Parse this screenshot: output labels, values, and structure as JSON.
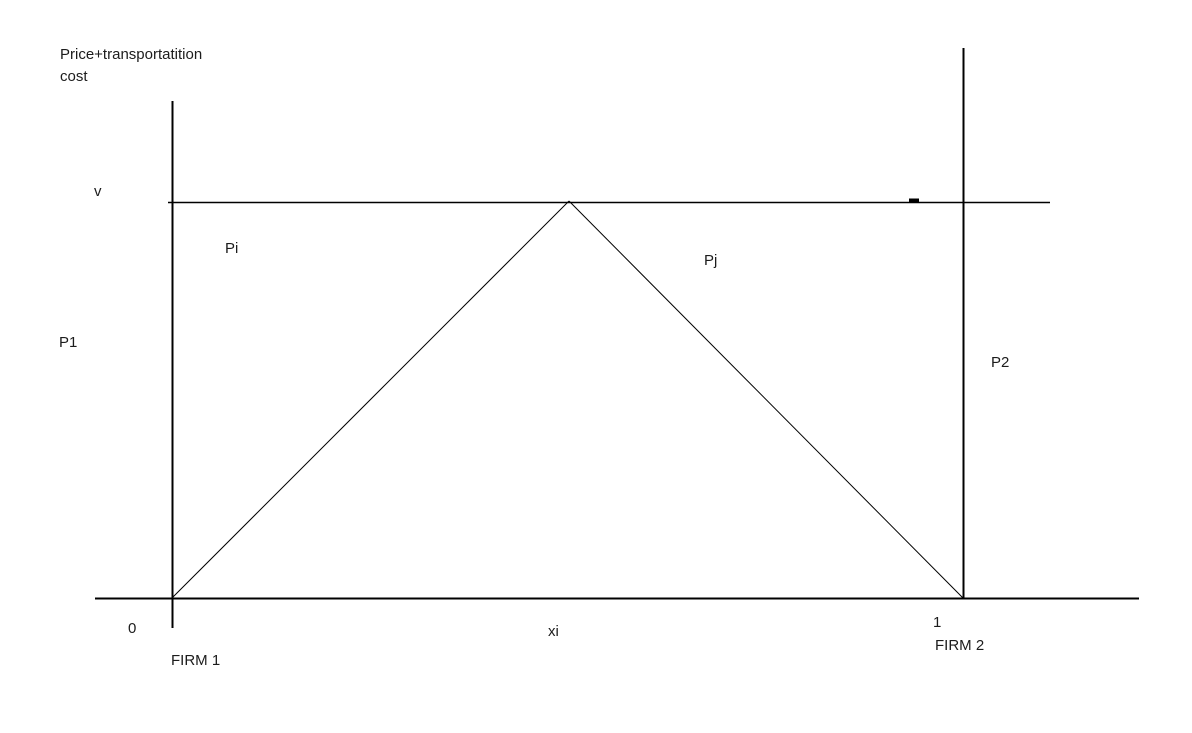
{
  "diagram": {
    "y_axis_title": "Price+transportatition cost",
    "labels": {
      "v": "v",
      "pi": "Pi",
      "pj": "Pj",
      "p1": "P1",
      "p2": "P2",
      "origin": "0",
      "xi": "xi",
      "one": "1",
      "firm1": "FIRM 1",
      "firm2": "FIRM 2"
    },
    "colors": {
      "line": "#000000",
      "background": "#ffffff",
      "text": "#1c1c1c"
    }
  }
}
